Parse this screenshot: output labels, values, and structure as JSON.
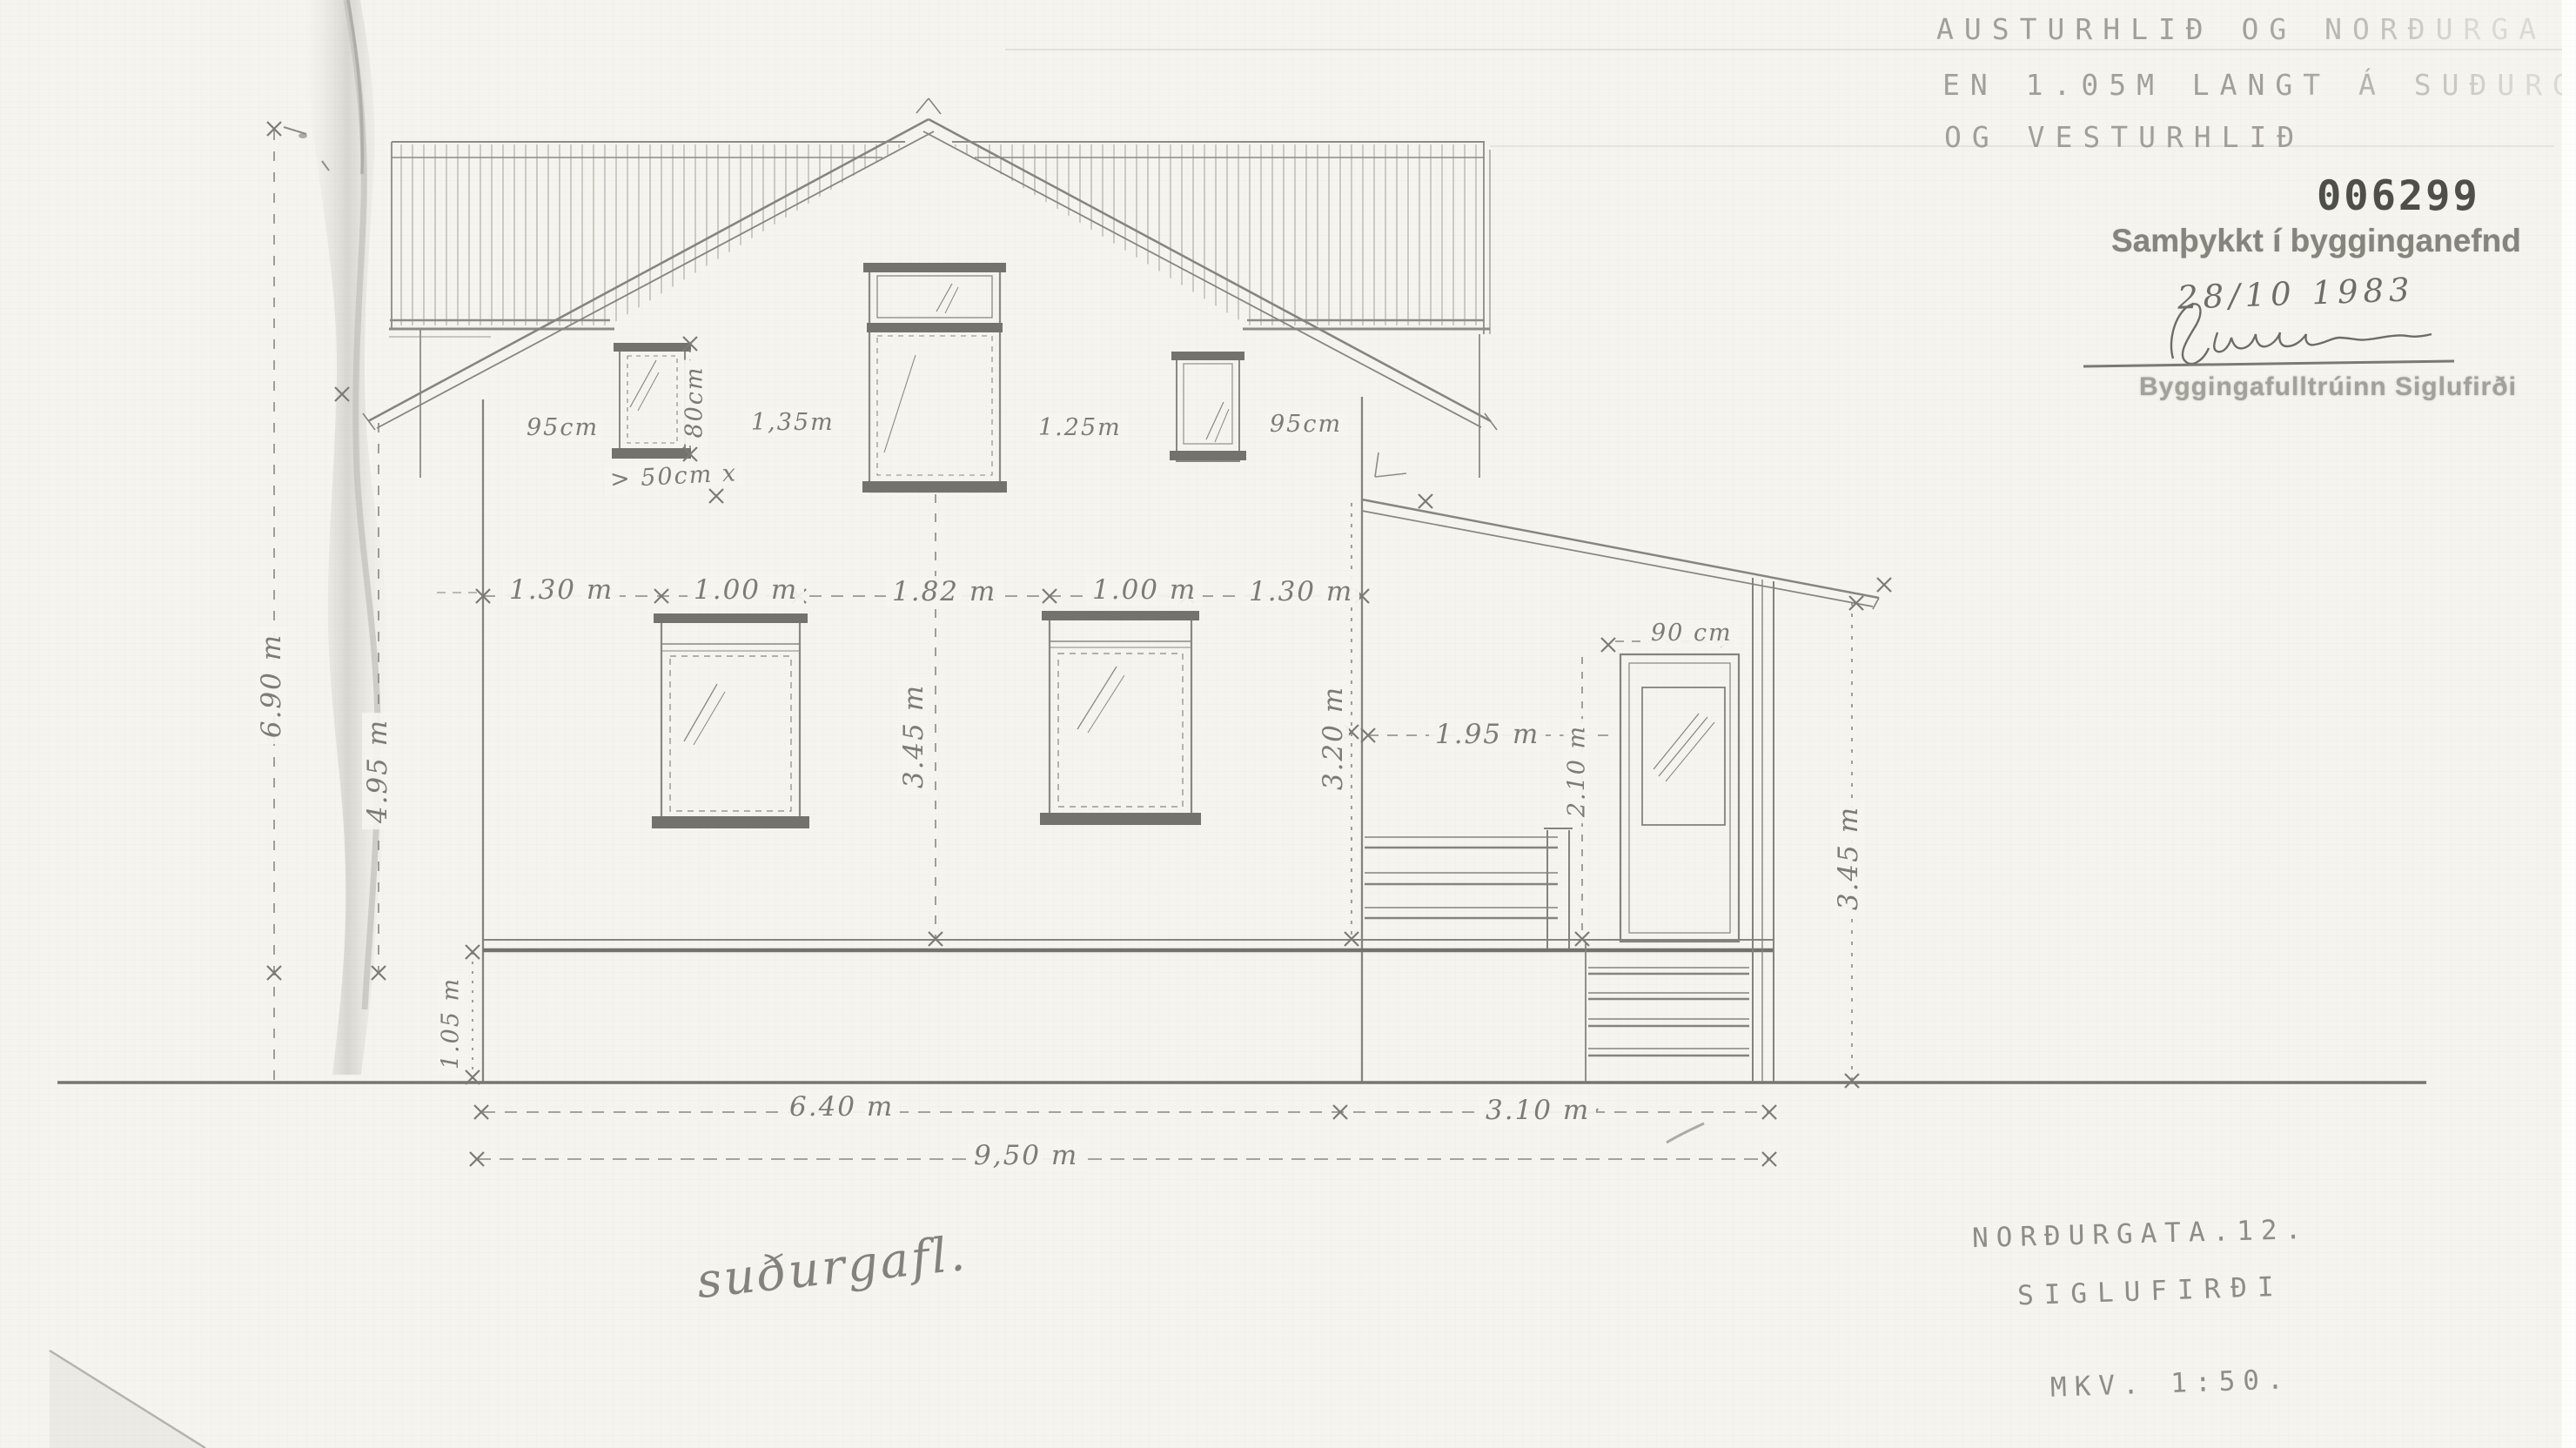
{
  "sheet": {
    "view_label": "suðurgafl.",
    "top_note": {
      "line1": "AUSTURHLIÐ OG NORÐURGA",
      "line2": "EN 1.05M LANGT Á SUÐURGA",
      "line3": "OG VESTURHLIÐ"
    },
    "stamp": {
      "number": "006299",
      "approved": "Samþykkt í bygginganefnd",
      "date": "28/10 1983",
      "office": "Byggingafulltrúinn Siglufirði"
    },
    "title_block": {
      "street": "NORÐURGATA.12.",
      "town": "SIGLUFIRÐI",
      "scale": "MKV. 1:50."
    },
    "dims": {
      "gable_left": "95cm",
      "gable_mid_left": "1,35m",
      "gable_mid_right": "1.25m",
      "gable_right": "95cm",
      "gable_window_height": "80cm",
      "sill_note": "> 50cm x",
      "wall_a": "1.30 m",
      "win_a": "1.00 m",
      "wall_b": "1.82 m",
      "win_b": "1.00 m",
      "wall_c": "1.30 m",
      "total_height": "6.90 m",
      "wall_height": "4.95 m",
      "plinth_height": "1.05 m",
      "floor_height": "3.45 m",
      "porch_attach_height": "3.20 m",
      "porch_width": "1.95 m",
      "door_height": "2.10 m",
      "door_width": "90 cm",
      "porch_height": "3.45 m",
      "bottom_main": "6.40 m",
      "bottom_porch": "3.10 m",
      "bottom_total": "9,50 m"
    },
    "colors": {
      "pencil": "#8e8c85",
      "pencil_dark": "#6b6963",
      "paper": "#f5f4ef"
    }
  }
}
